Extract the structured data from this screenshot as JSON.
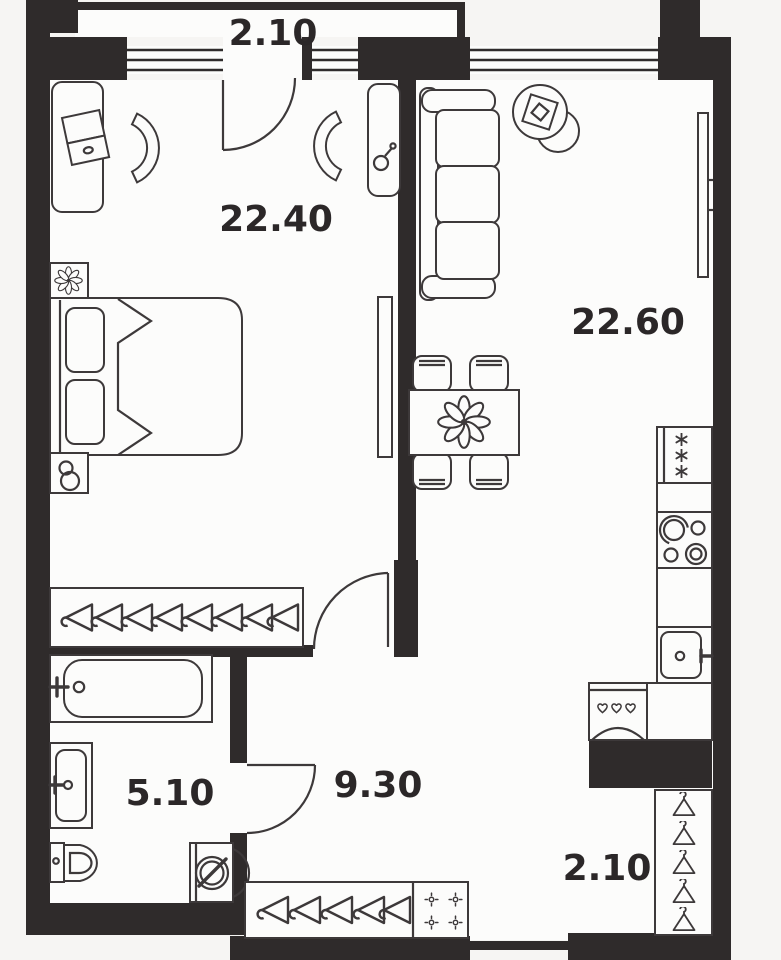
{
  "plan": {
    "type": "apartment-floor-plan",
    "rooms": [
      {
        "name": "balcony-top",
        "area_label": "2.10"
      },
      {
        "name": "bedroom",
        "area_label": "22.40"
      },
      {
        "name": "living-kitchen",
        "area_label": "22.60"
      },
      {
        "name": "bathroom",
        "area_label": "5.10"
      },
      {
        "name": "hallway",
        "area_label": "9.30"
      },
      {
        "name": "loggia-bottom",
        "area_label": "2.10"
      }
    ],
    "colors": {
      "wall": "#2f2b2b",
      "line": "#3d393a",
      "floor": "#fcfcfb",
      "background": "#f6f5f3",
      "label": "#2b2728"
    },
    "icons": {
      "hanger": "clothes-hanger glyph (triangle with hook)",
      "flower": "8-petal flower decor glyph",
      "snowflake": "freezer asterisk glyph",
      "cross-dot": "shoe-cabinet circle with four ticks",
      "heart-knob": "washer drop/heart knobs"
    }
  }
}
